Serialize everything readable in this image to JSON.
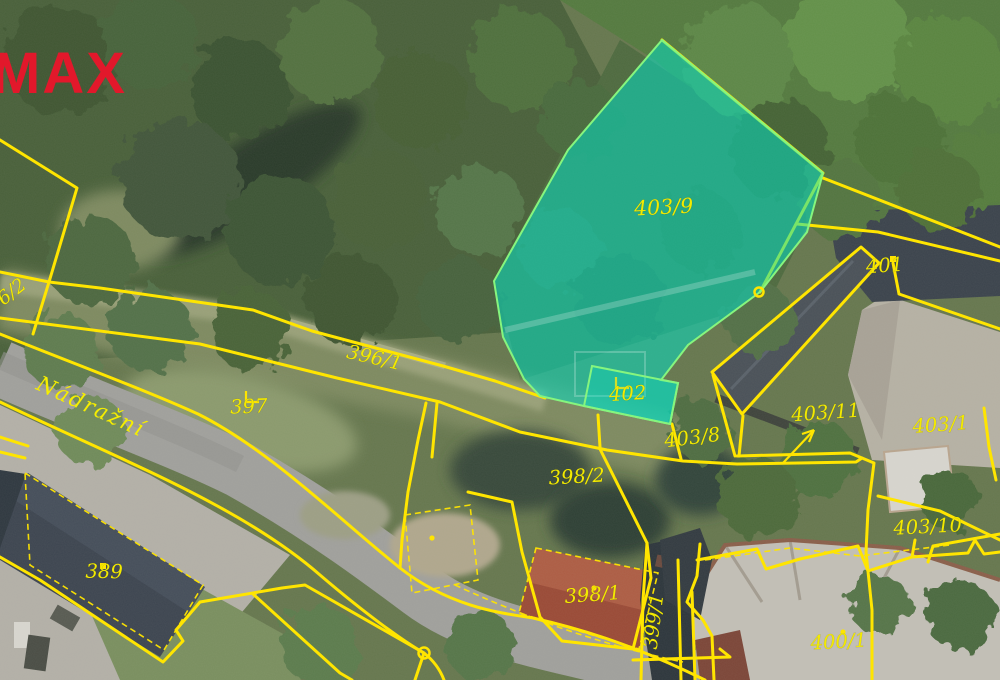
{
  "watermark": {
    "text": "MAX",
    "color": "#e2182b"
  },
  "street": {
    "name": "Nádražní"
  },
  "map_style": {
    "cadastral_line_color": "#ffe500",
    "parcel_label_color": "#f3ea00",
    "highlight_fill": "#00e2c8",
    "highlight_outline": "#86f57e",
    "background_type": "aerial-orthophoto"
  },
  "markers": {
    "circle_markers": 2,
    "dot_markers": 5,
    "corner_markers": 2,
    "arrow_to_parcel": "403/11"
  },
  "parcels": {
    "p396_2": {
      "label": "396/2"
    },
    "p396_1": {
      "label": "396/1"
    },
    "p397": {
      "label": "397"
    },
    "p389": {
      "label": "389"
    },
    "p398_2": {
      "label": "398/2"
    },
    "p398_1": {
      "label": "398/1"
    },
    "p399_1": {
      "label": "399/1"
    },
    "p400_1": {
      "label": "400/1"
    },
    "p401": {
      "label": "401"
    },
    "p402": {
      "label": "402",
      "highlighted": true
    },
    "p403_9": {
      "label": "403/9",
      "highlighted": true
    },
    "p403_8": {
      "label": "403/8"
    },
    "p403_11": {
      "label": "403/11"
    },
    "p403_1": {
      "label": "403/1"
    },
    "p403_10": {
      "label": "403/10"
    }
  }
}
